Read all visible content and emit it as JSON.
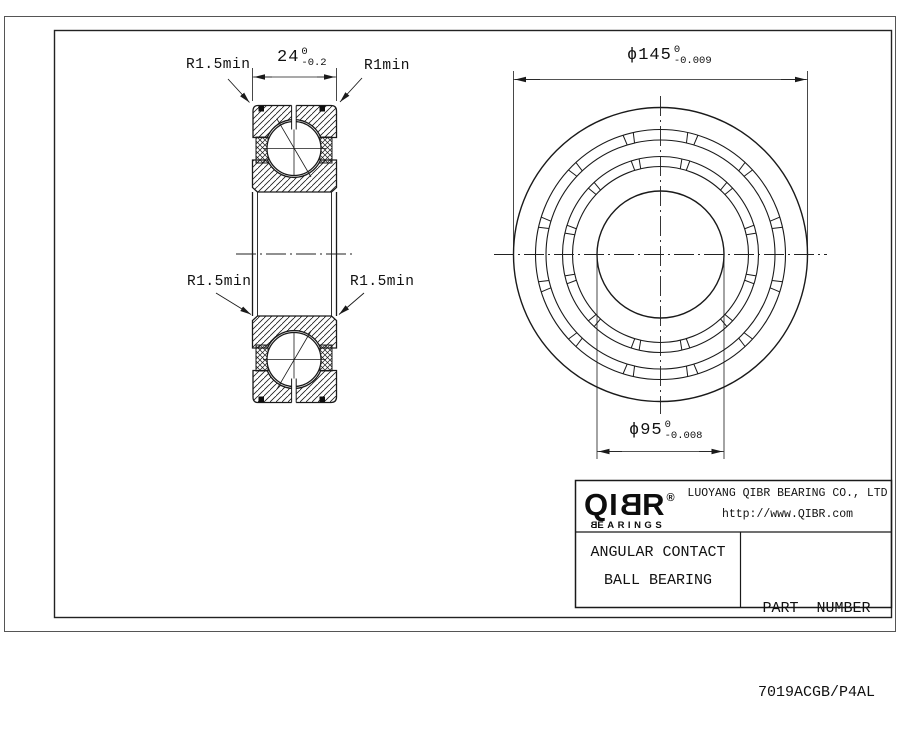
{
  "section_view": {
    "width_dim": {
      "prefix": "",
      "value": "24",
      "tol_top": "0",
      "tol_bottom": "-0.2"
    },
    "corner_labels": {
      "top_left": "R1.5min",
      "top_right": "R1min",
      "bottom_left": "R1.5min",
      "bottom_right": "R1.5min"
    }
  },
  "front_view": {
    "outer_dia_dim": {
      "prefix": "ϕ",
      "value": "145",
      "tol_top": "0",
      "tol_bottom": "-0.009"
    },
    "bore_dia_dim": {
      "prefix": "ϕ",
      "value": "95",
      "tol_top": "0",
      "tol_bottom": "-0.008"
    }
  },
  "title_block": {
    "logo": {
      "l1": "Q",
      "l2": "I",
      "l3": "B",
      "l4": "R",
      "registered": "®",
      "tagline_pre": "B",
      "tagline_rest": "EARINGS"
    },
    "company_name": "LUOYANG QIBR BEARING CO., LTD",
    "company_url": "http://www.QIBR.com",
    "product_type_line1": "ANGULAR CONTACT",
    "product_type_line2": "BALL BEARING",
    "part_number_label": "PART  NUMBER",
    "part_number": "7019ACGB/P4AL"
  },
  "colors": {
    "line": "#1a1a1a",
    "background": "#ffffff"
  }
}
